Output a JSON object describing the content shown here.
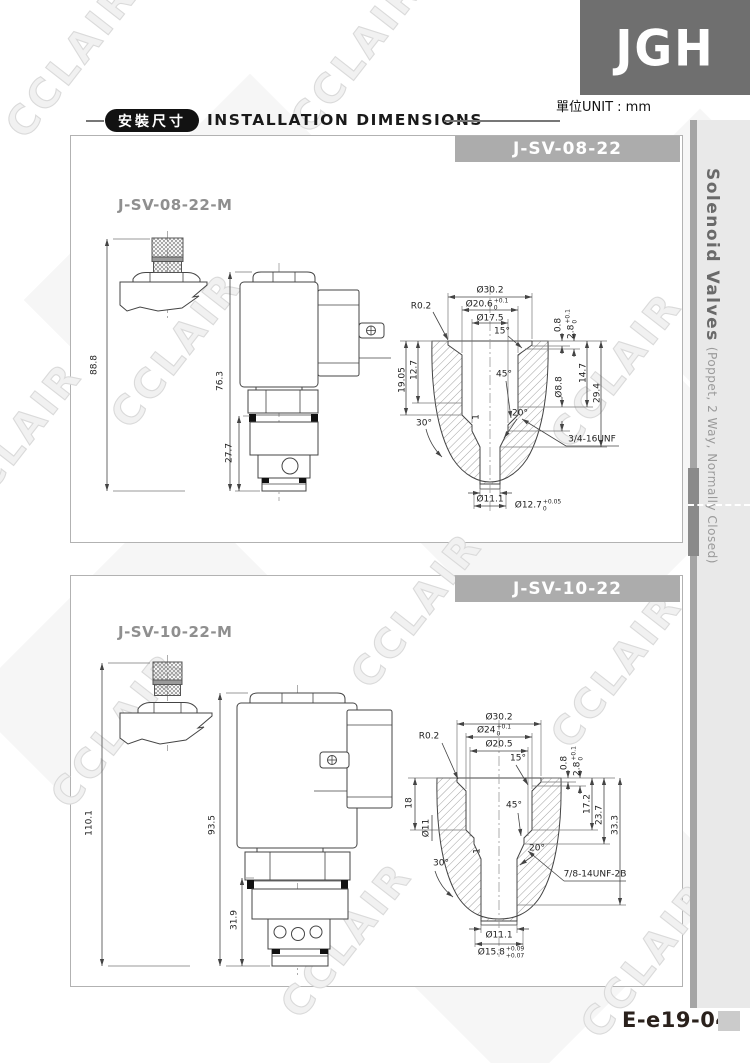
{
  "page": {
    "logo": "JGH",
    "unit": "單位UNIT : mm",
    "doc_code": "E-e19-04",
    "watermark": "CCLAIR"
  },
  "header": {
    "badge": "安裝尺寸",
    "title": "INSTALLATION DIMENSIONS"
  },
  "sidebar": {
    "title": "Solenoid Valves",
    "subtitle": "(Poppet, 2 Way, Normally Closed)"
  },
  "panel1": {
    "model": "J-SV-08-22",
    "manual_model": "J-SV-08-22-M",
    "dims": {
      "overall": "88.8",
      "coil": "76.3",
      "cartridge": "27.7",
      "d30": "Ø30.2",
      "d206": "Ø20.6",
      "d206_hi": "+0.1",
      "d206_lo": "0",
      "d175": "Ø17.5",
      "r": "R0.2",
      "a15": "15°",
      "a45": "45°",
      "a20": "20°",
      "a30": "30°",
      "s08": "0.8",
      "s28": "2.8",
      "s28_hi": "+0.1",
      "s28_lo": "0",
      "d147": "14.7",
      "d294": "29.4",
      "d88": "Ø8.8",
      "depth1": "19.05",
      "depth2": "12.7",
      "ch": "1",
      "thread": "3/4-16UNF",
      "d111": "Ø11.1",
      "d127": "Ø12.7",
      "d127_hi": "+0.05",
      "d127_lo": "0"
    }
  },
  "panel2": {
    "model": "J-SV-10-22",
    "manual_model": "J-SV-10-22-M",
    "dims": {
      "overall": "110.1",
      "coil": "93.5",
      "cartridge": "31.9",
      "d30": "Ø30.2",
      "d24": "Ø24",
      "d24_hi": "+0.1",
      "d24_lo": "0",
      "d205": "Ø20.5",
      "r": "R0.2",
      "a15": "15°",
      "a45": "45°",
      "a20": "20°",
      "a30": "30°",
      "s08": "0.8",
      "s28": "2.8",
      "s28_hi": "+0.1",
      "s28_lo": "0",
      "d172": "17.2",
      "d237": "23.7",
      "d333": "33.3",
      "depth1": "18",
      "d11": "Ø11",
      "ch": "1",
      "thread": "7/8-14UNF-2B",
      "d111": "Ø11.1",
      "d158": "Ø15.8",
      "d158_hi": "+0.09",
      "d158_lo": "+0.07"
    }
  }
}
